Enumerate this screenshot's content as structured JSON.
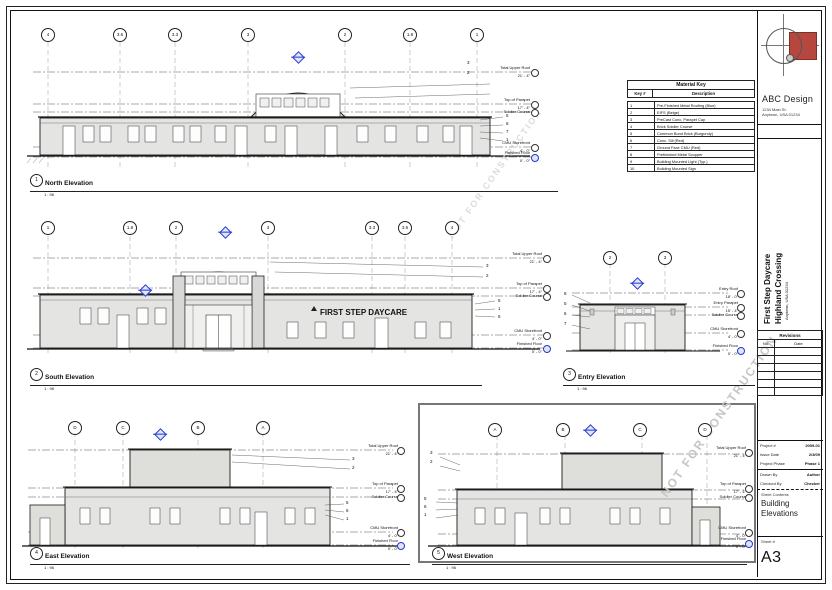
{
  "sheet": {
    "watermark": "NOT FOR CONSTRUCTION",
    "firm": {
      "name": "ABC Design",
      "address_line1": "1234 Main St.",
      "address_line2": "Anytown, USA 01234"
    },
    "project": {
      "name_line1": "First Step Daycare",
      "name_line2": "Highland Crossing",
      "address": "Anytown, USA 01234"
    },
    "revisions": {
      "title": "Revisions",
      "col_no": "No.",
      "col_date": "Date"
    },
    "info": {
      "project_label": "Project #",
      "project_value": "2009-01",
      "issue_label": "Issue Date",
      "issue_value": "2/3/09",
      "phase_label": "Project Phase",
      "phase_value": "Phase 1",
      "drawn_label": "Drawn By",
      "drawn_value": "Author",
      "checked_label": "Checked By",
      "checked_value": "Checker",
      "contents_label": "Sheet Contents",
      "contents_value": "Building Elevations",
      "sheet_label": "Sheet #",
      "sheet_value": "A3"
    }
  },
  "material_key": {
    "title": "Material Key",
    "col_key": "Key #",
    "col_desc": "Description",
    "rows": [
      {
        "num": "1",
        "desc": "Pre-Finished Metal Roofing (Blue)"
      },
      {
        "num": "2",
        "desc": "EIFS (Beige)"
      },
      {
        "num": "3",
        "desc": "PreCast Conc. Parapet Cap"
      },
      {
        "num": "4",
        "desc": "Brick Soldier Course"
      },
      {
        "num": "5",
        "desc": "Common Bond Brick (Burgundy)"
      },
      {
        "num": "6",
        "desc": "Conc. Sill (Red)"
      },
      {
        "num": "7",
        "desc": "Ground Face CMU (Red)"
      },
      {
        "num": "8",
        "desc": "Prefinished Metal Scupper"
      },
      {
        "num": "9",
        "desc": "Building Mounted Light (Typ.)"
      },
      {
        "num": "10",
        "desc": "Building Mounted Sign"
      }
    ]
  },
  "elevations": {
    "north": {
      "number": "1",
      "title": "North Elevation",
      "scale": "1 : 96",
      "grids": [
        "4",
        "3.6",
        "3.3",
        "3",
        "2",
        "1.8",
        "1"
      ],
      "levels": [
        {
          "name": "Total Upper Roof",
          "value": "21' - 4\""
        },
        {
          "name": "Top of Parapet",
          "value": "17' - 4\""
        },
        {
          "name": "Soldier Course",
          "value": "16' - 0\""
        },
        {
          "name": "CMU Storefront",
          "value": "4' - 0\""
        },
        {
          "name": "Finished Floor",
          "value": "0' - 0\""
        }
      ],
      "keynotes": [
        "3",
        "2",
        "5",
        "6",
        "7",
        "1"
      ]
    },
    "south": {
      "number": "2",
      "title": "South Elevation",
      "scale": "1 : 96",
      "sign": "FIRST STEP DAYCARE",
      "grids": [
        "1",
        "1.8",
        "2",
        "3",
        "3.3",
        "3.6",
        "4"
      ],
      "levels": [
        {
          "name": "Total Upper Roof",
          "value": "21' - 4\""
        },
        {
          "name": "Top of Parapet",
          "value": "17' - 4\""
        },
        {
          "name": "Soldier Course",
          "value": "16' - 0\""
        },
        {
          "name": "CMU Storefront",
          "value": "4' - 0\""
        },
        {
          "name": "Finished Floor",
          "value": "0' - 0\""
        }
      ],
      "keynotes": [
        "3",
        "2",
        "5",
        "1",
        "6"
      ]
    },
    "entry": {
      "number": "3",
      "title": "Entry Elevation",
      "scale": "1 : 96",
      "grids": [
        "2",
        "3"
      ],
      "levels": [
        {
          "name": "Entry Roof",
          "value": "18' - 0\""
        },
        {
          "name": "Entry Parapet",
          "value": "15' - 4\""
        },
        {
          "name": "Soldier Course",
          "value": "14' - 0\""
        },
        {
          "name": "CMU Storefront",
          "value": "4' - 0\""
        },
        {
          "name": "Finished Floor",
          "value": "0' - 0\""
        }
      ],
      "keynotes": [
        "8",
        "5",
        "6",
        "7"
      ]
    },
    "east": {
      "number": "4",
      "title": "East Elevation",
      "scale": "1 : 96",
      "grids": [
        "D",
        "C",
        "B",
        "A"
      ],
      "levels": [
        {
          "name": "Total Upper Roof",
          "value": "21' - 4\""
        },
        {
          "name": "Top of Parapet",
          "value": "17' - 4\""
        },
        {
          "name": "Soldier Course",
          "value": "16' - 0\""
        },
        {
          "name": "CMU Storefront",
          "value": "4' - 0\""
        },
        {
          "name": "Finished Floor",
          "value": "0' - 0\""
        }
      ],
      "keynotes": [
        "3",
        "2",
        "5",
        "6",
        "1"
      ]
    },
    "west": {
      "number": "5",
      "title": "West Elevation",
      "scale": "1 : 96",
      "grids": [
        "A",
        "B",
        "C",
        "D"
      ],
      "levels": [
        {
          "name": "Total Upper Roof",
          "value": "21' - 4\""
        },
        {
          "name": "Top of Parapet",
          "value": "17' - 4\""
        },
        {
          "name": "Soldier Course",
          "value": "16' - 0\""
        },
        {
          "name": "CMU Storefront",
          "value": "4' - 0\""
        },
        {
          "name": "Finished Floor",
          "value": "0' - 0\""
        }
      ],
      "keynotes": [
        "3",
        "2",
        "5",
        "6",
        "1"
      ]
    }
  }
}
